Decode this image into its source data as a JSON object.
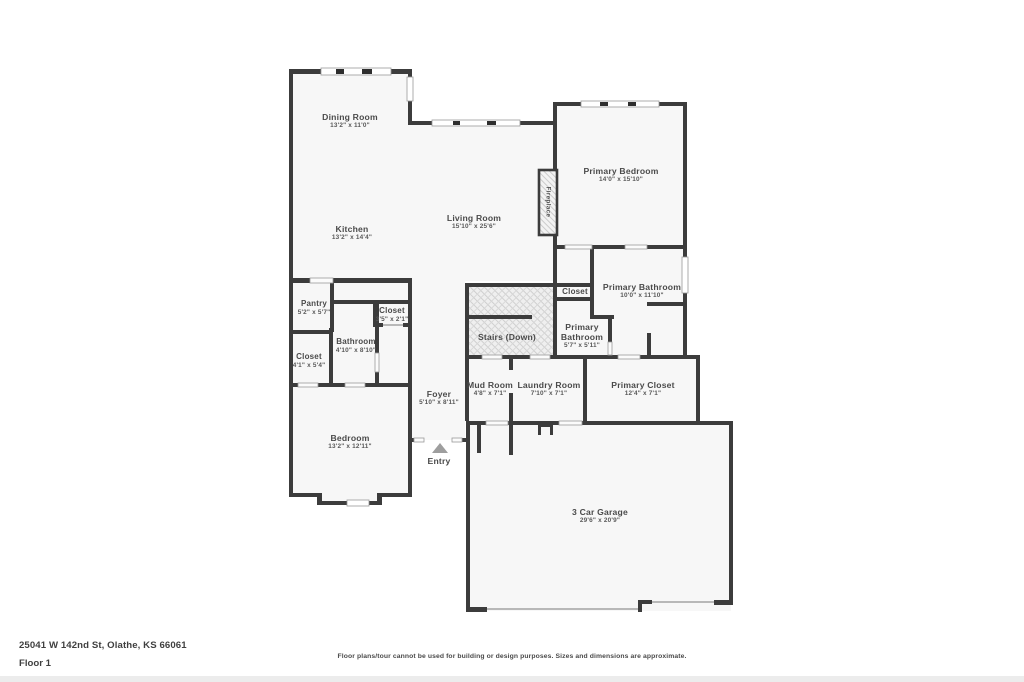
{
  "floorplan": {
    "rooms": {
      "dining": {
        "name": "Dining Room",
        "dims": "13'2\" x 11'0\""
      },
      "kitchen": {
        "name": "Kitchen",
        "dims": "13'2\" x 14'4\""
      },
      "living": {
        "name": "Living Room",
        "dims": "15'10\" x 25'6\""
      },
      "primary_bedroom": {
        "name": "Primary Bedroom",
        "dims": "14'0\" x 15'10\""
      },
      "fireplace": {
        "name": "Fireplace"
      },
      "closet_mid": {
        "name": "Closet"
      },
      "primary_bathroom": {
        "name": "Primary Bathroom",
        "dims": "10'0\" x 11'10\""
      },
      "primary_bath_small": {
        "name": "Primary Bathroom",
        "dims": "5'7\" x 5'11\""
      },
      "stairs": {
        "name": "Stairs (Down)"
      },
      "pantry": {
        "name": "Pantry",
        "dims": "5'2\" x 5'7\""
      },
      "closet_small": {
        "name": "Closet",
        "dims": "3'5\" x 2'1\""
      },
      "bathroom": {
        "name": "Bathroom",
        "dims": "4'10\" x 8'10\""
      },
      "closet_lower": {
        "name": "Closet",
        "dims": "4'1\" x 5'4\""
      },
      "mud_room": {
        "name": "Mud Room",
        "dims": "4'8\" x 7'1\""
      },
      "laundry": {
        "name": "Laundry Room",
        "dims": "7'10\" x 7'1\""
      },
      "primary_closet": {
        "name": "Primary Closet",
        "dims": "12'4\" x 7'1\""
      },
      "foyer": {
        "name": "Foyer",
        "dims": "5'10\" x 8'11\""
      },
      "bedroom": {
        "name": "Bedroom",
        "dims": "13'2\" x 12'11\""
      },
      "entry": {
        "name": "Entry"
      },
      "garage": {
        "name": "3 Car Garage",
        "dims": "29'6\" x 20'9\""
      }
    },
    "footer": {
      "address": "25041 W 142nd St, Olathe, KS 66061",
      "floor_label": "Floor 1",
      "disclaimer": "Floor plans/tour cannot be used for building or design purposes. Sizes and dimensions are approximate."
    },
    "colors": {
      "wall": "#3c3c3c",
      "room_fill": "#f7f7f7",
      "label_text": "#4a4a4a",
      "bottom_bar": "#ececec"
    }
  }
}
